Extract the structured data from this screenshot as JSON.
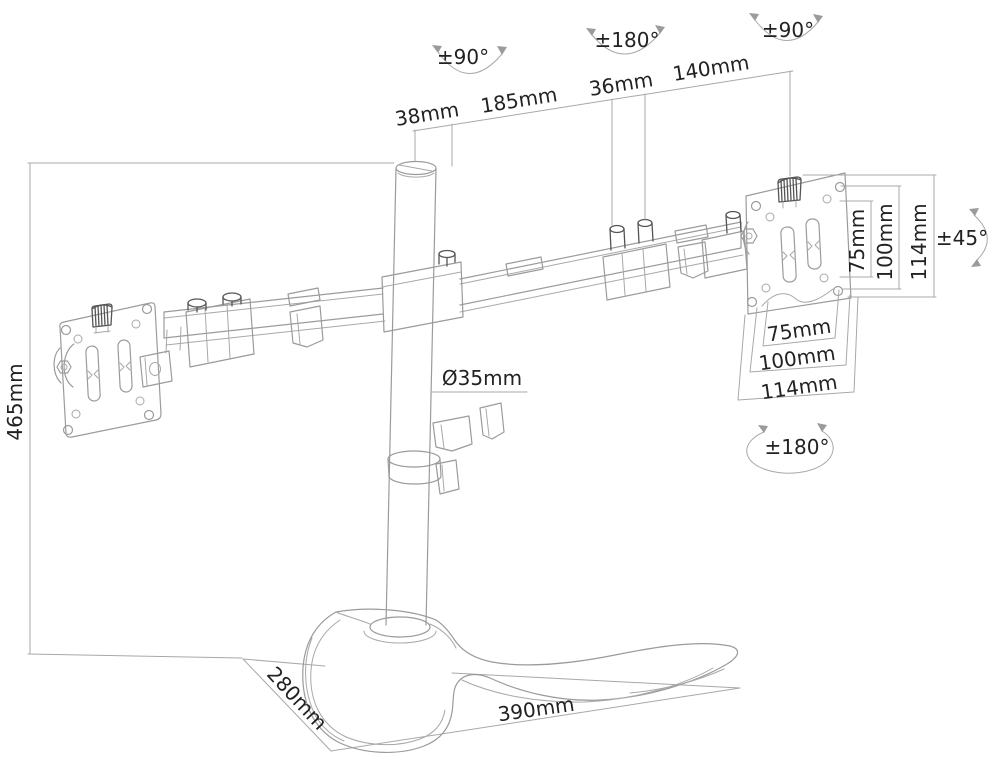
{
  "diagram": {
    "type": "technical-dimension-drawing",
    "subject": "dual monitor desk stand with crossbar, pole, VESA plates and base",
    "background_color": "#ffffff",
    "line_color": "#9b9b9b",
    "text_color": "#222222"
  },
  "dims": {
    "top": [
      "38mm",
      "185mm",
      "36mm",
      "140mm"
    ],
    "pole_height": "465mm",
    "pole_diameter": "Ø35mm",
    "vesa_vertical": [
      "75mm",
      "100mm",
      "114mm"
    ],
    "vesa_horizontal": [
      "75mm",
      "100mm",
      "114mm"
    ],
    "base_depth": "280mm",
    "base_width": "390mm"
  },
  "angles": {
    "pole_swivel": "±90°",
    "arm_swivel": "±180°",
    "head_swivel": "±90°",
    "tilt": "±45°",
    "vesa_rotate": "±180°"
  }
}
